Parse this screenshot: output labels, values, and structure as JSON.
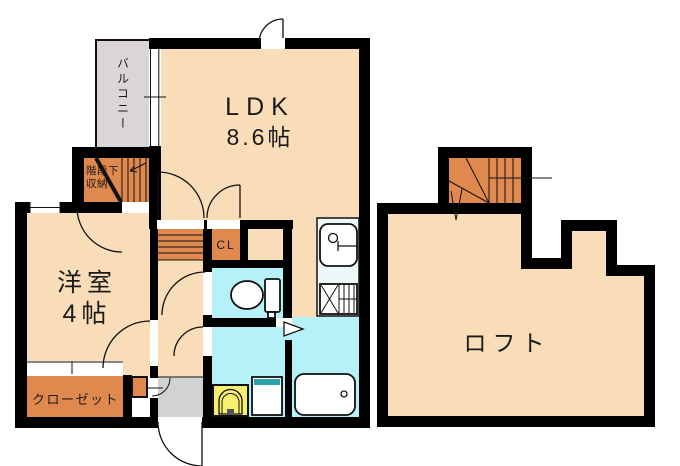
{
  "rooms": {
    "ldk": {
      "label": "LDK",
      "size": "8.6帖"
    },
    "western_room": {
      "label": "洋室",
      "size": "4帖"
    },
    "loft": {
      "label": "ロフト"
    },
    "balcony": {
      "label": "バルコニー"
    },
    "closet": {
      "label": "クローゼット"
    },
    "cl_closet": {
      "label": "CL"
    },
    "under_stair_storage": {
      "line1": "階段下",
      "line2": "収納"
    }
  },
  "colors": {
    "wall": "#000000",
    "floor": "#F9DDB8",
    "stairs_and_storage": "#E0894E",
    "wet_area": "#B5F1F7",
    "balcony": "#D9D5D9",
    "entrance": "#D2D2D2",
    "laundry_pan": "#F7EF6E",
    "washbasin_accent": "#2AA0A8",
    "kitchen_counter": "#ECF7F8"
  }
}
